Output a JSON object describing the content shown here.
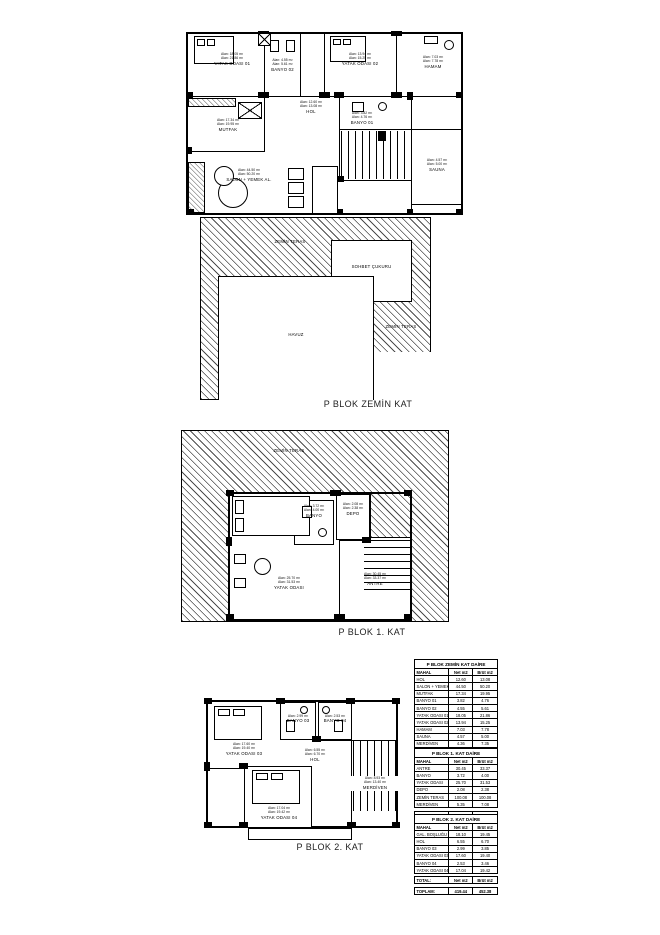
{
  "titles": {
    "zemin": "P BLOK ZEMİN KAT",
    "kat1": "P BLOK 1. KAT",
    "kat2": "P BLOK 2. KAT"
  },
  "plans": {
    "zemin": {
      "rooms": {
        "yatak01": {
          "name": "YATAK ODASI 01",
          "area1": "Alan: 18.05 m²",
          "area2": "Alan: 21.86 m²"
        },
        "yatak02": {
          "name": "YATAK ODASI 02",
          "area1": "Alan: 13.94 m²",
          "area2": "Alan: 15.25 m²"
        },
        "hamam": {
          "name": "HAMAM",
          "area1": "Alan: 7.03 m²",
          "area2": "Alan: 7.78 m²"
        },
        "banyo02": {
          "name": "BANYO 02",
          "area1": "Alan: 4.55 m²",
          "area2": "Alan: 5.61 m²"
        },
        "mutfak": {
          "name": "MUTFAK",
          "area1": "Alan: 17.34 m²",
          "area2": "Alan: 19.95 m²"
        },
        "hol": {
          "name": "HOL",
          "area1": "Alan: 12.60 m²",
          "area2": "Alan: 13.08 m²"
        },
        "banyo01": {
          "name": "BANYO 01",
          "area1": "Alan: 3.82 m²",
          "area2": "Alan: 4.76 m²"
        },
        "salon": {
          "name": "SALON + YEMEK AL.",
          "area1": "Alan: 44.50 m²",
          "area2": "Alan: 50.20 m²"
        },
        "sauna": {
          "name": "SAUNA",
          "area1": "Alan: 4.57 m²",
          "area2": "Alan: 5.00 m²"
        },
        "teras_top": {
          "name": "ZEMİN TERAS"
        },
        "sohbet": {
          "name": "SOHBET ÇUKURU"
        },
        "havuz": {
          "name": "HAVUZ"
        },
        "teras_right": {
          "name": "ZEMİN TERAS"
        }
      }
    },
    "kat1": {
      "rooms": {
        "teras": {
          "name": "ZEMİN TERAS"
        },
        "banyo": {
          "name": "BANYO",
          "area1": "Alan: 3.72 m²",
          "area2": "Alan: 4.00 m²"
        },
        "depo": {
          "name": "DEPO",
          "area1": "Alan: 2.08 m²",
          "area2": "Alan: 2.38 m²"
        },
        "yatak": {
          "name": "YATAK ODASI",
          "area1": "Alan: 25.70 m²",
          "area2": "Alan: 31.53 m²"
        },
        "antre": {
          "name": "ANTRE",
          "area1": "Alan: 30.45 m²",
          "area2": "Alan: 33.37 m²"
        }
      }
    },
    "kat2": {
      "rooms": {
        "yatak03": {
          "name": "YATAK ODASI 03",
          "area1": "Alan: 17.60 m²",
          "area2": "Alan: 19.40 m²"
        },
        "banyo03": {
          "name": "BANYO 03",
          "area1": "Alan: 2.99 m²",
          "area2": "Alan: 3.85 m²"
        },
        "banyo04": {
          "name": "BANYO 04",
          "area1": "Alan: 2.53 m²",
          "area2": "Alan: 3.46 m²"
        },
        "hol": {
          "name": "HOL",
          "area1": "Alan: 6.55 m²",
          "area2": "Alan: 6.70 m²"
        },
        "merdiven": {
          "name": "MERDİVEN",
          "area1": "Alan: 8.93 m²",
          "area2": "Alan: 13.40 m²"
        },
        "yatak04": {
          "name": "YATAK ODASI 04",
          "area1": "Alan: 17.04 m²",
          "area2": "Alan: 19.42 m²"
        }
      }
    }
  },
  "tables": [
    {
      "title": "P BLOK ZEMİN KAT DAİRE",
      "headers": [
        "MAHAL",
        "Net m2",
        "Brüt m2"
      ],
      "rows": [
        [
          "HOL",
          "12.60",
          "13.08"
        ],
        [
          "SALON + YEMEK AL.",
          "44.50",
          "50.20"
        ],
        [
          "MUTFAK",
          "17.34",
          "19.95"
        ],
        [
          "BANYO 01",
          "3.82",
          "4.76"
        ],
        [
          "BANYO 02",
          "4.55",
          "5.61"
        ],
        [
          "YATAK ODASI 01",
          "18.05",
          "21.86"
        ],
        [
          "YATAK ODASI 02",
          "13.94",
          "15.25"
        ],
        [
          "HAMAM",
          "7.03",
          "7.78"
        ],
        [
          "SAUNA",
          "4.57",
          "5.00"
        ],
        [
          "MERDİVEN",
          "4.36",
          "7.35"
        ],
        [
          "HAVUZ",
          "30.00",
          "30.00"
        ],
        [
          "ZEMİN TERAS",
          "38.00",
          "38.00"
        ]
      ],
      "total": [
        "TOPLAM",
        "203.28",
        "219.56"
      ]
    },
    {
      "title": "P BLOK 1. KAT DAİRE",
      "headers": [
        "MAHAL",
        "Net m2",
        "Brüt m2"
      ],
      "rows": [
        [
          "ANTRE",
          "30.45",
          "33.37"
        ],
        [
          "BANYO",
          "3.72",
          "4.00"
        ],
        [
          "YATAK ODASI",
          "25.70",
          "31.53"
        ],
        [
          "DEPO",
          "2.08",
          "2.38"
        ],
        [
          "ZEMİN TERAS",
          "100.08",
          "100.08"
        ],
        [
          "MERDİVEN",
          "5.35",
          "7.08"
        ]
      ],
      "total": [
        "TOPLAM",
        "167.38",
        "178.44"
      ]
    },
    {
      "title": "P BLOK 2. KAT DAİRE",
      "headers": [
        "MAHAL",
        "Net m2",
        "Brüt m2"
      ],
      "rows": [
        [
          "GAL. BOŞLUĞU",
          "18.10",
          "19.45"
        ],
        [
          "HOL",
          "6.55",
          "6.70"
        ],
        [
          "BANYO 03",
          "2.99",
          "3.85"
        ],
        [
          "YATAK ODASI 03",
          "17.60",
          "19.40"
        ],
        [
          "BANYO 04",
          "2.53",
          "3.46"
        ],
        [
          "YATAK ODASI 04",
          "17.04",
          "19.42"
        ]
      ],
      "total": [
        "TOPLAM",
        "48.35",
        "54.37"
      ]
    }
  ],
  "grand_total": {
    "row1": [
      "TOTAL:",
      "Net m2",
      "Brüt m2"
    ],
    "row2": [
      "TOPLAM:",
      "419.44",
      "452.38"
    ]
  }
}
